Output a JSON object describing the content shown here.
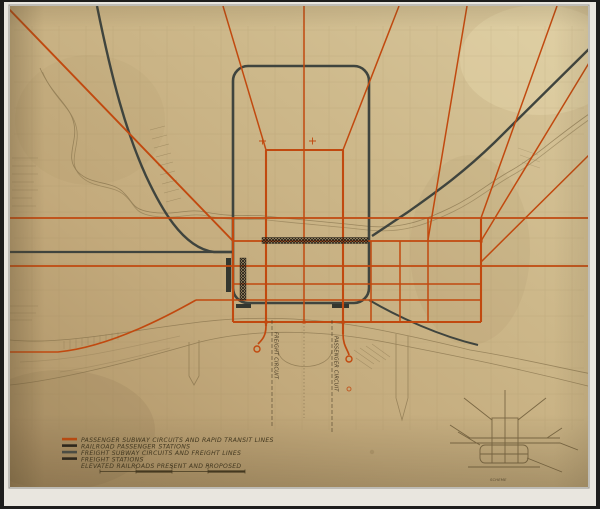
{
  "legend": {
    "items": [
      {
        "label": "PASSENGER SUBWAY CIRCUITS AND RAPID TRANSIT LINES",
        "color": "#c04a10"
      },
      {
        "label": "RAILROAD PASSENGER STATIONS",
        "color": "#28231a"
      },
      {
        "label": "FREIGHT SUBWAY CIRCUITS AND FREIGHT LINES",
        "color": "#4a4e47"
      },
      {
        "label": "FREIGHT STATIONS",
        "color": "#28231a"
      },
      {
        "label": "ELEVATED RAILROADS PRESENT AND PROPOSED",
        "color": "#3f351d"
      }
    ],
    "scale_ticks": [
      "1",
      "2",
      "3"
    ]
  },
  "map_labels": {
    "freight_circuit": "FREIGHT CIRCUIT",
    "passenger_circuit": "PASSENGER CIRCUIT"
  },
  "inset": {
    "caption": "SCHEME"
  },
  "colors": {
    "paper": "#c9b183",
    "passenger_line": "#c1490f",
    "freight_line": "#3f443e",
    "station_hatch": "#241f17",
    "sepia": "#7c6944"
  }
}
